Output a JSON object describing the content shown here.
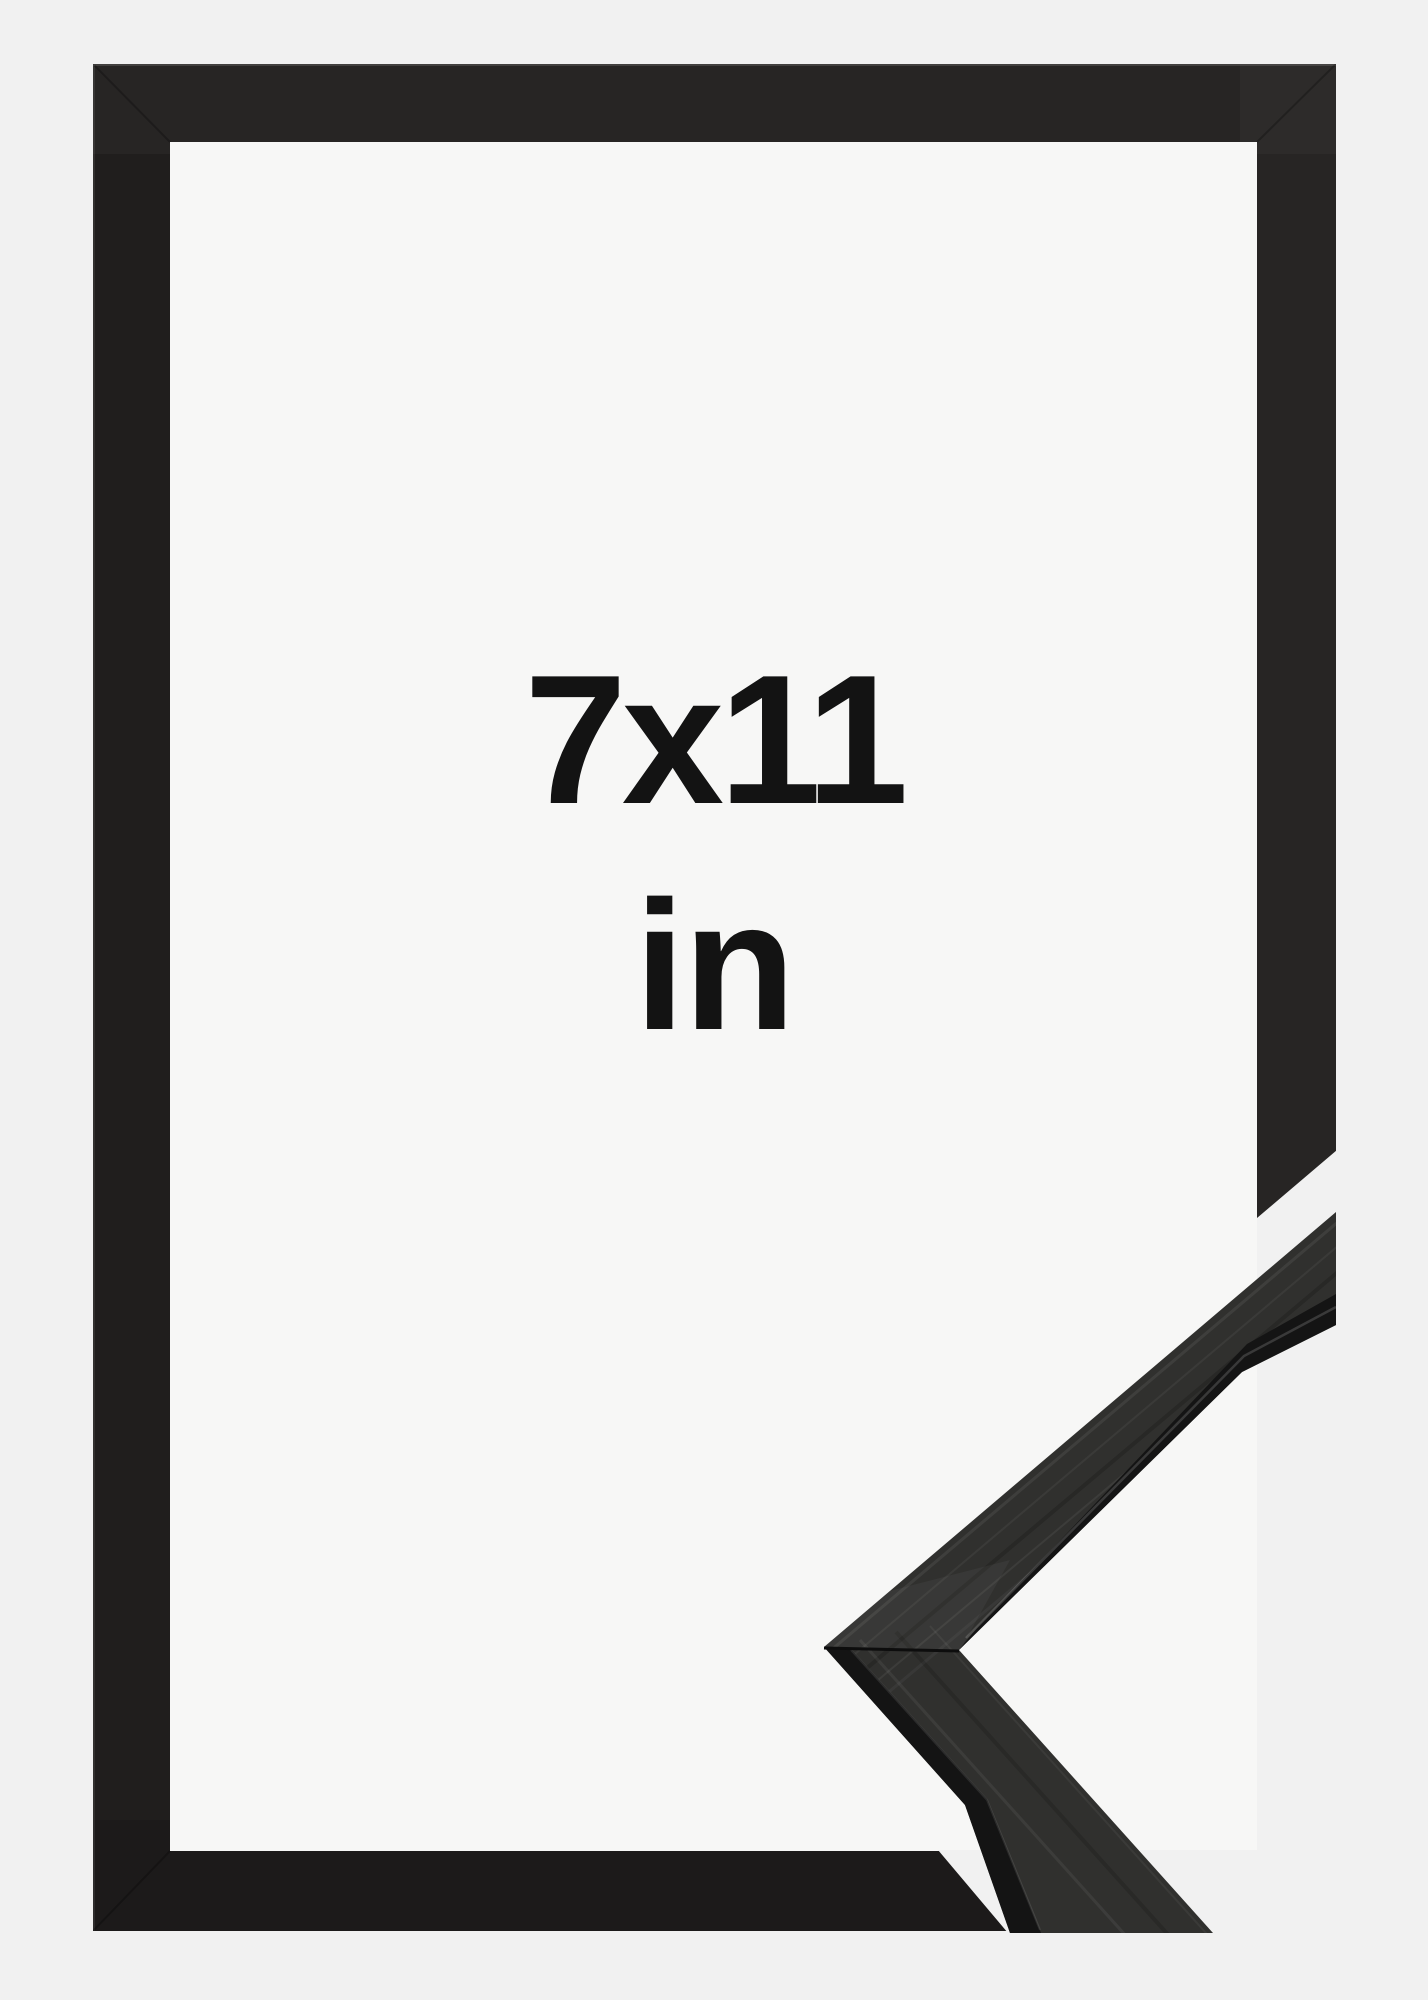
{
  "product_image": {
    "size_text": "7x11",
    "unit_text": "in",
    "subject": "black picture frame with mitered corner sample"
  },
  "colors": {
    "background": "#f1f1f1",
    "frame_interior": "#f7f7f6",
    "frame_black": "#201e1d",
    "sample_top_face": "#30302e",
    "sample_side_face": "#141414",
    "label_text": "#131313"
  }
}
